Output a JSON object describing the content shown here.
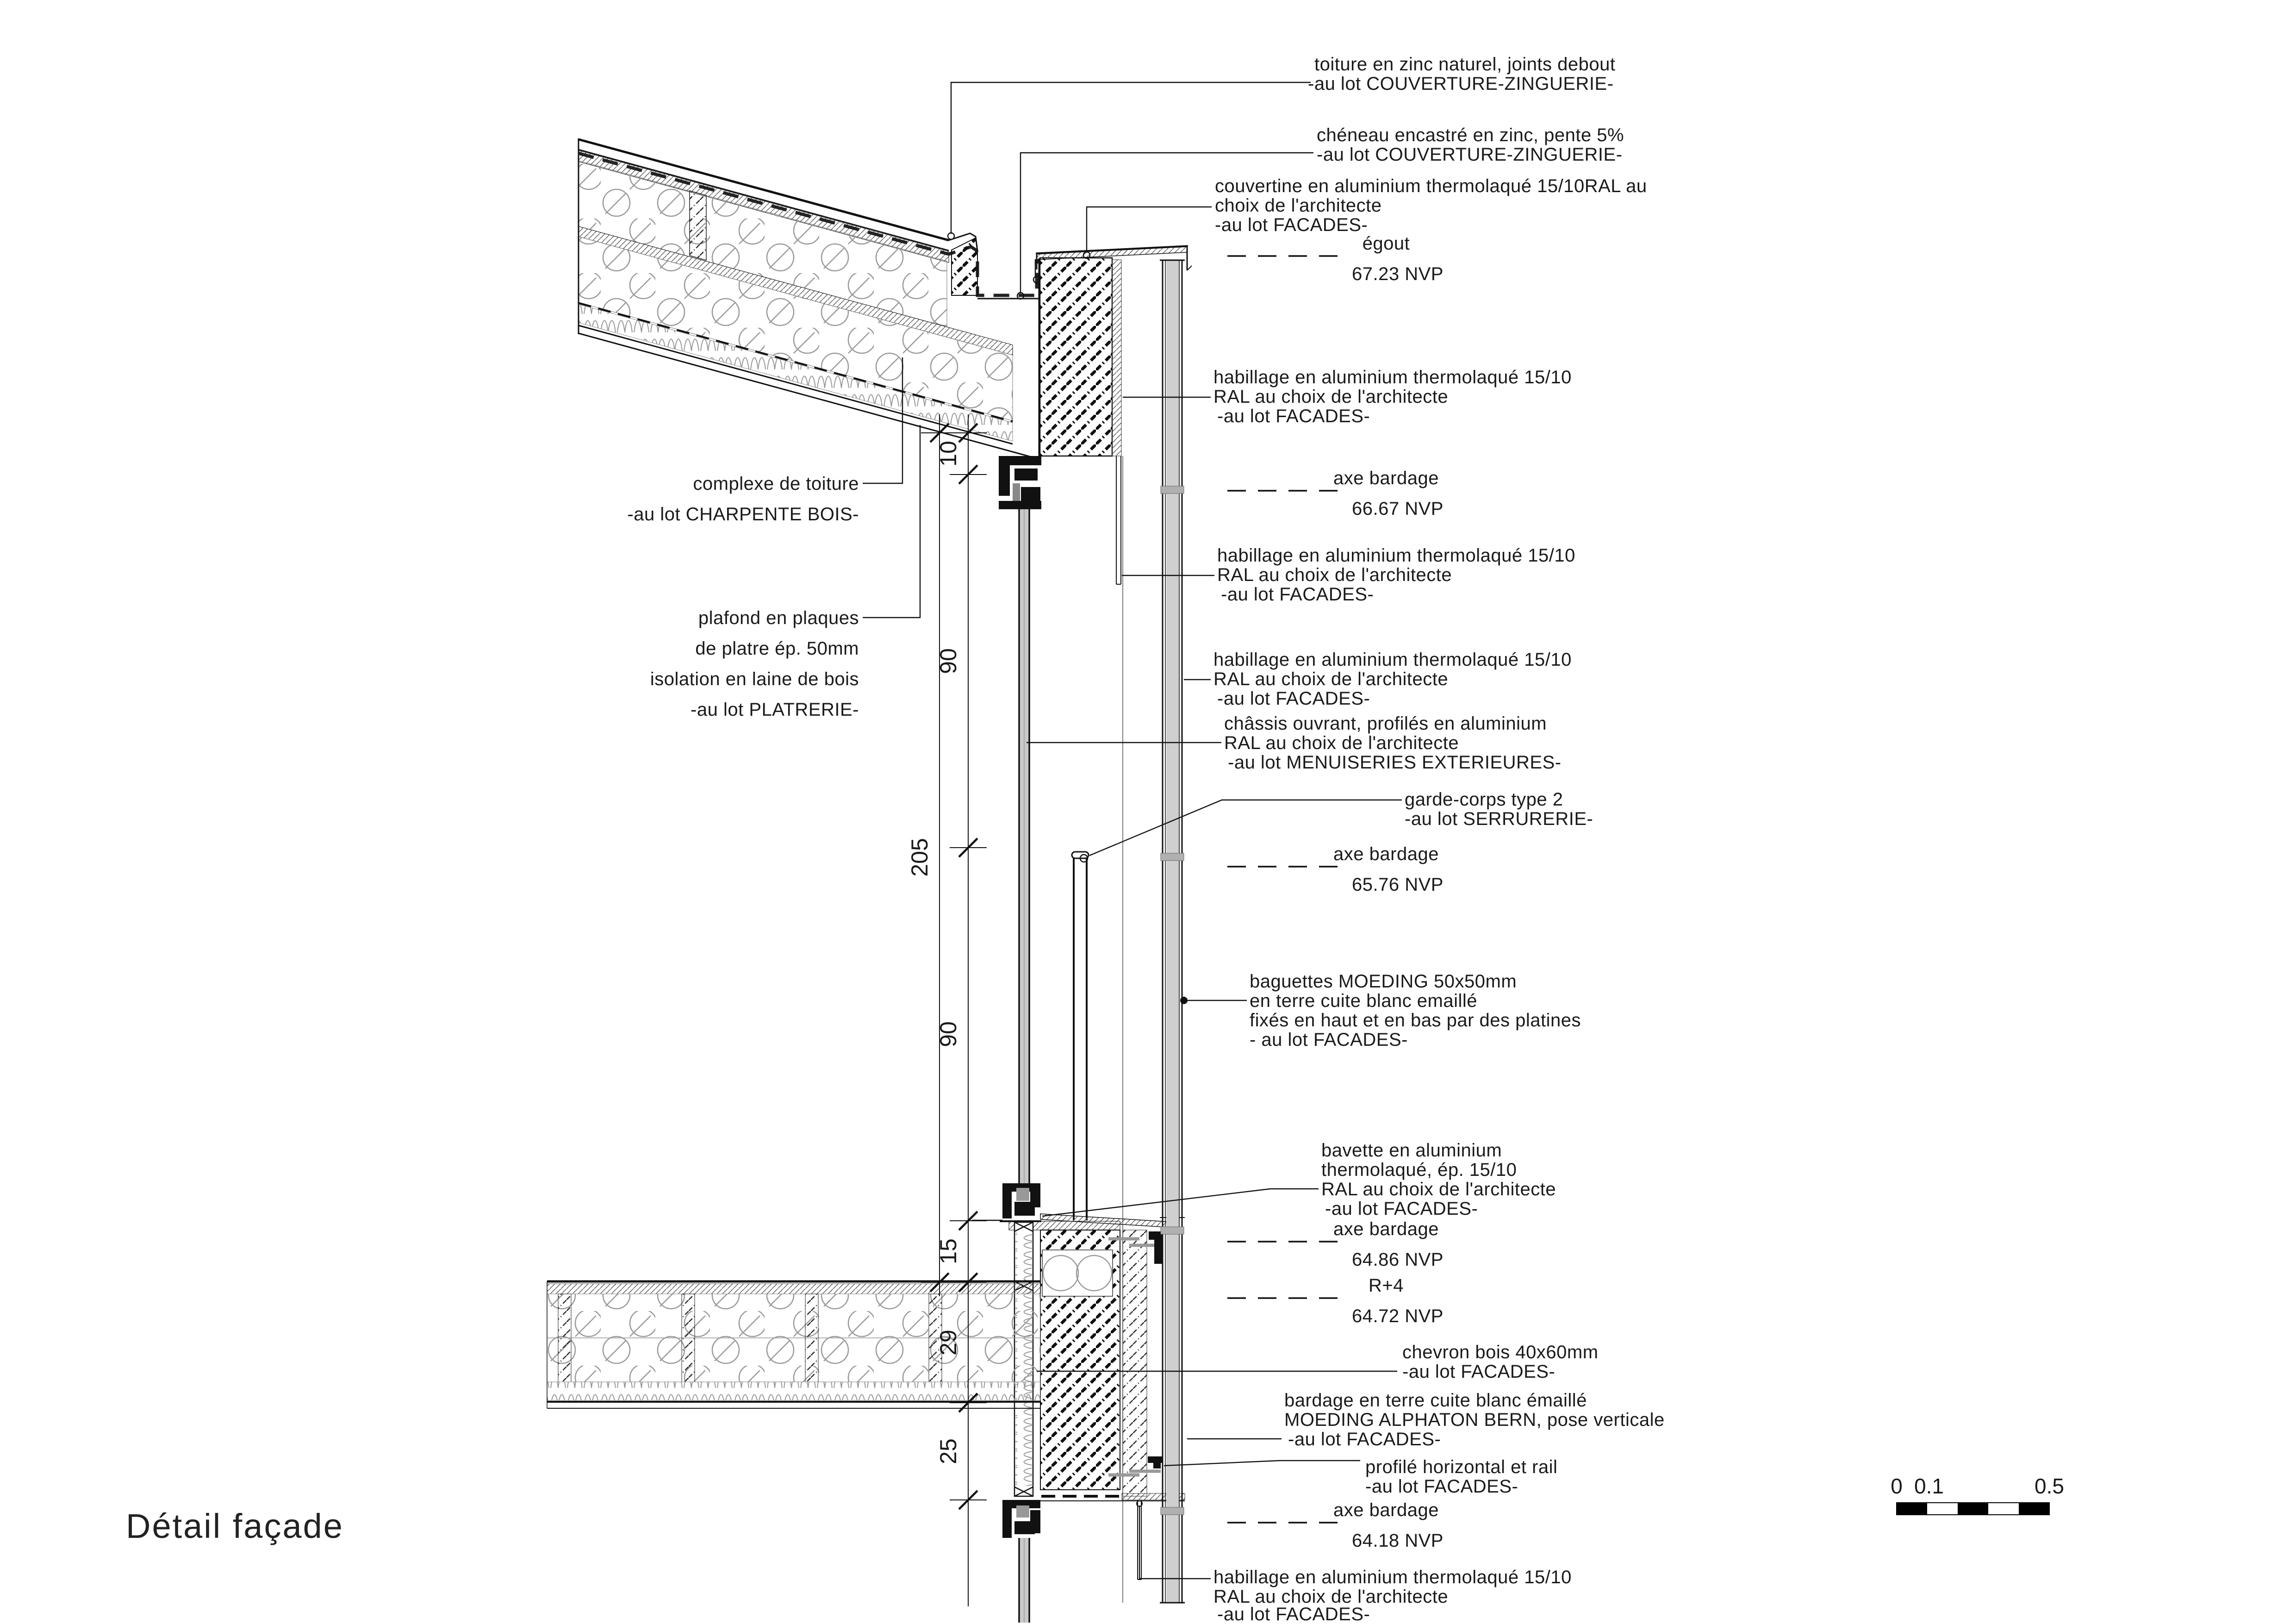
{
  "title": "Détail façade",
  "annotations": {
    "toiture": {
      "l1": "toiture en zinc naturel, joints debout",
      "l2": "-au lot COUVERTURE-ZINGUERIE-"
    },
    "cheneau": {
      "l1": "chéneau encastré en zinc, pente 5%",
      "l2": "-au lot COUVERTURE-ZINGUERIE-"
    },
    "couvertine": {
      "l1": "couvertine en aluminium thermolaqué 15/10RAL au",
      "l2": "choix de l'architecte",
      "l3": "-au lot FACADES-"
    },
    "habillage": {
      "l1": "habillage en aluminium thermolaqué 15/10",
      "l2": "RAL au choix de l'architecte",
      "l3": "-au lot FACADES-"
    },
    "chassis": {
      "l1": "châssis ouvrant, profilés en aluminium",
      "l2": "RAL au choix de l'architecte",
      "l3": "-au lot MENUISERIES EXTERIEURES-"
    },
    "garde_corps": {
      "l1": "garde-corps type 2",
      "l2": "-au lot SERRURERIE-"
    },
    "baguettes": {
      "l1": "baguettes MOEDING 50x50mm",
      "l2": "en terre cuite blanc emaillé",
      "l3": "fixés en haut et en bas par des platines",
      "l4": "- au lot FACADES-"
    },
    "bavette": {
      "l1": "bavette en aluminium",
      "l2": "thermolaqué, ép. 15/10",
      "l3": "RAL au choix de l'architecte",
      "l4": "-au lot FACADES-"
    },
    "chevron": {
      "l1": "chevron bois 40x60mm",
      "l2": "-au lot FACADES-"
    },
    "bardage": {
      "l1": "bardage en terre cuite blanc émaillé",
      "l2": "MOEDING ALPHATON BERN, pose verticale",
      "l3": "-au lot FACADES-"
    },
    "profile": {
      "l1": "profilé horizontal et rail",
      "l2": "-au lot FACADES-"
    },
    "complexe": {
      "l1": "complexe de toiture",
      "l2": "-au lot CHARPENTE BOIS-"
    },
    "plafond": {
      "l1": "plafond en plaques",
      "l2": "de platre ép. 50mm",
      "l3": "isolation en laine de bois",
      "l4": "-au lot PLATRERIE-"
    }
  },
  "levels": {
    "egout": {
      "label": "égout",
      "value": "67.23 NVP"
    },
    "axe1": {
      "label": "axe bardage",
      "value": "66.67 NVP"
    },
    "axe2": {
      "label": "axe bardage",
      "value": "65.76 NVP"
    },
    "axe3": {
      "label": "axe bardage",
      "value": "64.86 NVP"
    },
    "r4": {
      "label": "R+4",
      "value": "64.72 NVP"
    },
    "axe4": {
      "label": "axe bardage",
      "value": "64.18 NVP"
    }
  },
  "dimensions": {
    "d10": "10",
    "d90a": "90",
    "d205": "205",
    "d90b": "90",
    "d15": "15",
    "d29": "29",
    "d25": "25"
  },
  "scalebar": {
    "t0": "0",
    "t01": "0.1",
    "t05": "0.5"
  },
  "colors": {
    "line": "#111111",
    "insulation": "#9b9b9b",
    "glass_fill": "#c9c9c9",
    "platine": "#b0b0b0",
    "screw": "#999999"
  }
}
